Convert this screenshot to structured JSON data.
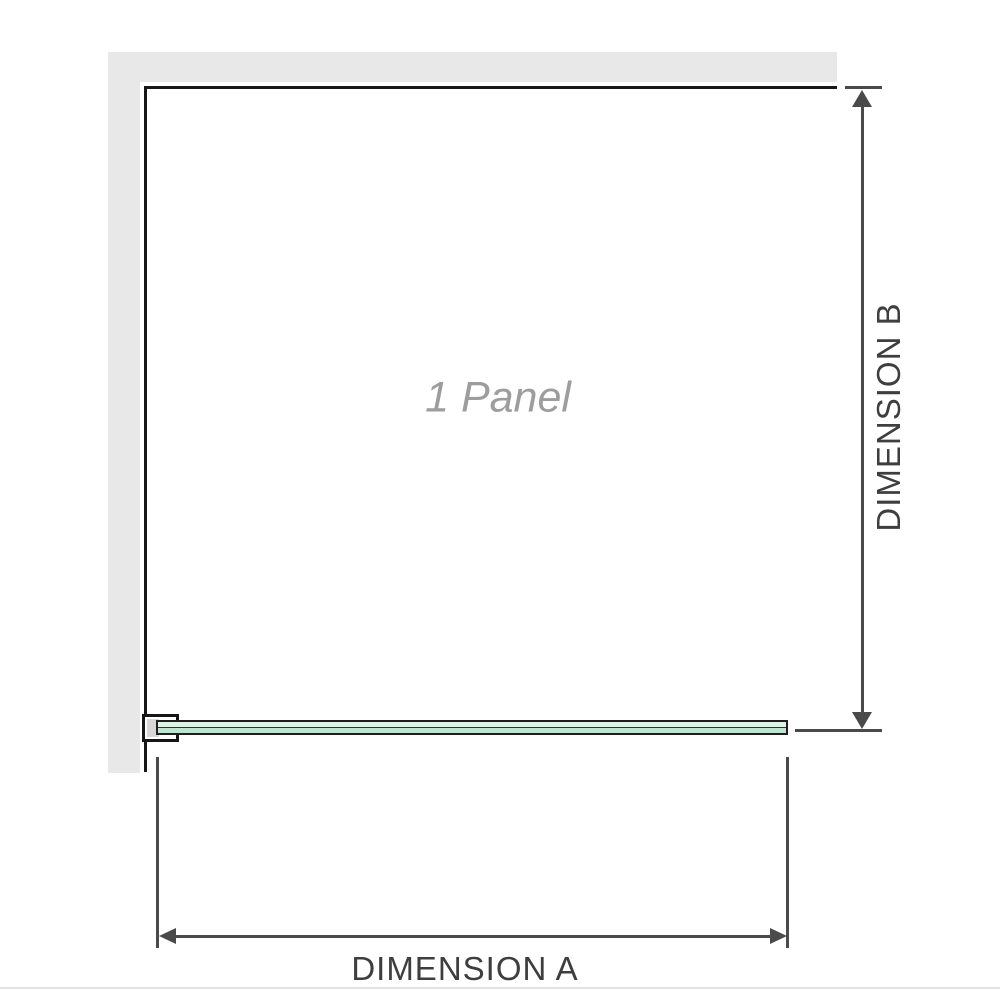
{
  "diagram": {
    "panel_label": "1 Panel",
    "dimensions": {
      "a_label": "DIMENSION A",
      "b_label": "DIMENSION B"
    },
    "colors": {
      "wall_fill": "#e8e8e8",
      "wall_line": "#171717",
      "dimension_line": "#4a4a4a",
      "dimension_text": "#3e3e3e",
      "panel_label_text": "#9d9d9d",
      "glass_top": "#dcf2e6",
      "glass_bottom": "#bce7cf",
      "glass_border": "#1f1f1f",
      "bracket_pad": "#d7d7d7"
    }
  }
}
